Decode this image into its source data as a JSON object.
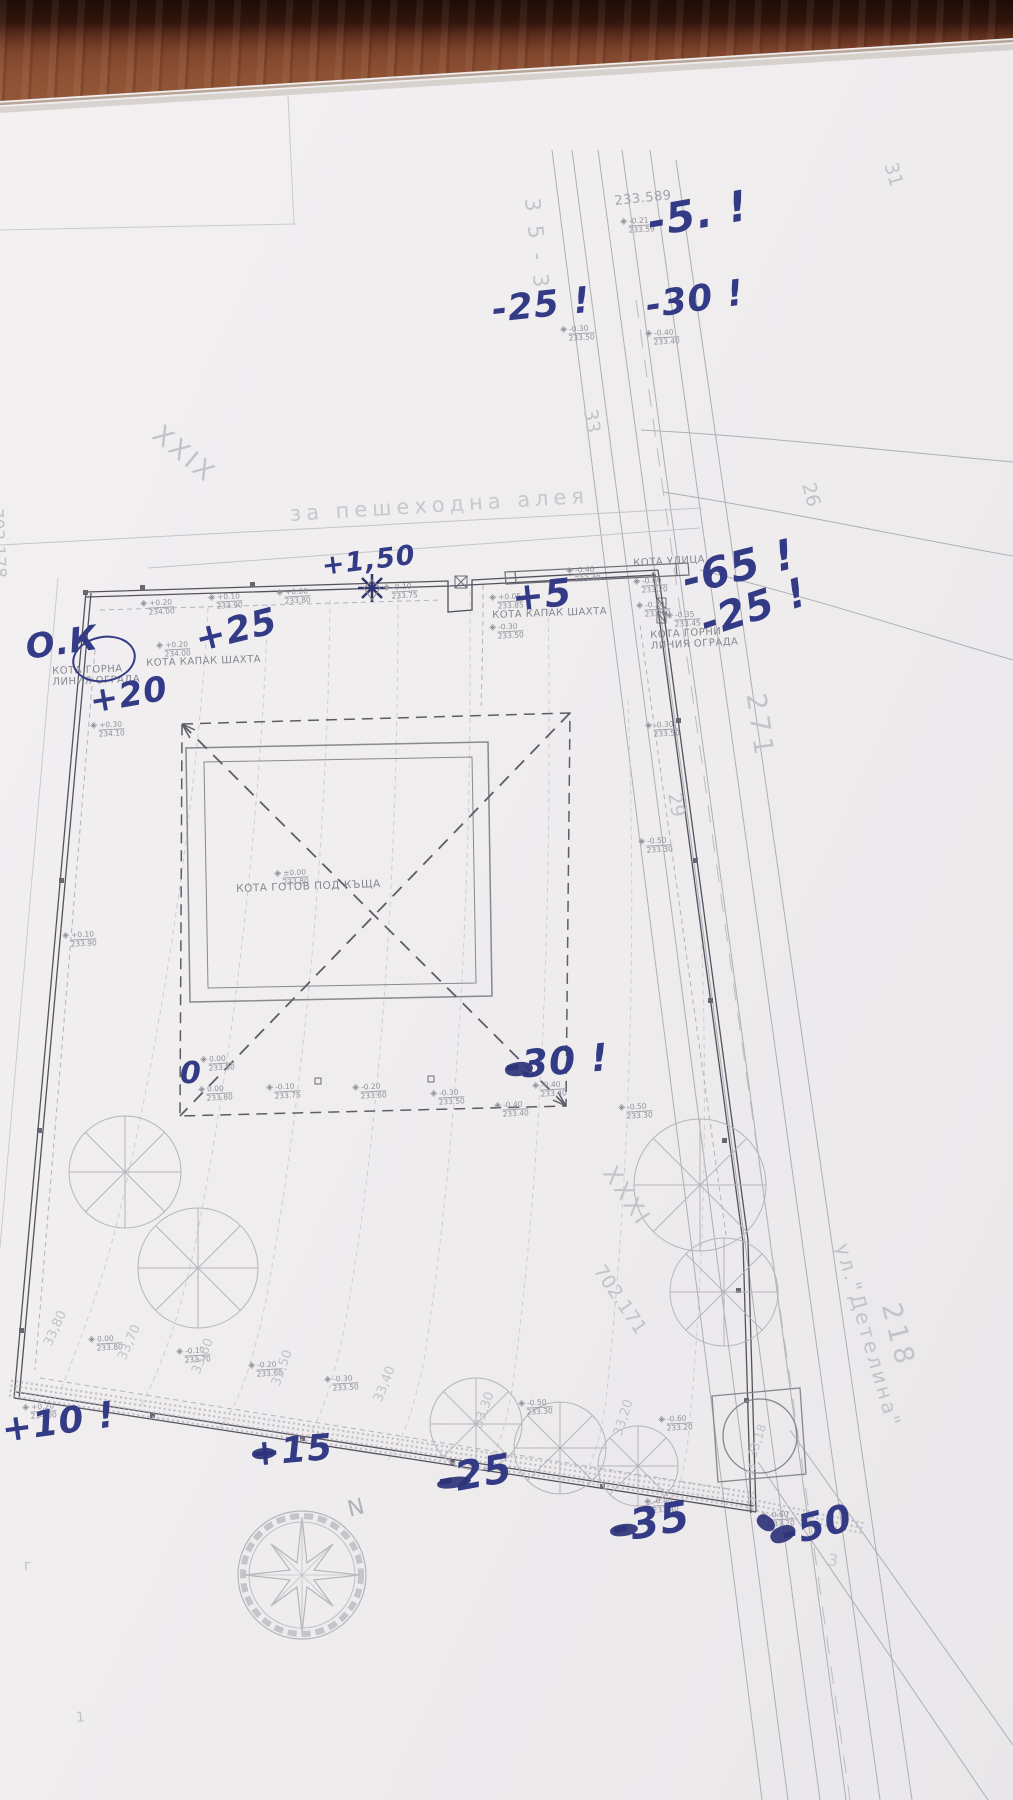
{
  "plan": {
    "handwritten": [
      {
        "text": "-5. !",
        "x": 648,
        "y": 198,
        "size": 42,
        "rot": -10
      },
      {
        "text": "-25 !",
        "x": 492,
        "y": 290,
        "size": 36,
        "rot": -6
      },
      {
        "text": "-30 !",
        "x": 646,
        "y": 286,
        "size": 36,
        "rot": -8
      },
      {
        "text": "+1,50",
        "x": 322,
        "y": 551,
        "size": 27,
        "rot": -7
      },
      {
        "text": "+5",
        "x": 512,
        "y": 576,
        "size": 38,
        "rot": -6
      },
      {
        "text": "-65 !",
        "x": 683,
        "y": 556,
        "size": 42,
        "rot": -14
      },
      {
        "text": "-25 !",
        "x": 702,
        "y": 602,
        "size": 40,
        "rot": -18
      },
      {
        "text": "О.К",
        "x": 26,
        "y": 628,
        "size": 34,
        "rot": -8
      },
      {
        "text": "+25",
        "x": 196,
        "y": 620,
        "size": 36,
        "rot": -14
      },
      {
        "text": "+20",
        "x": 90,
        "y": 682,
        "size": 34,
        "rot": -10
      },
      {
        "text": "0",
        "x": 180,
        "y": 1056,
        "size": 30,
        "rot": 0
      },
      {
        "text": "-30 !",
        "x": 505,
        "y": 1044,
        "size": 38,
        "rot": -5
      },
      {
        "text": "+10 !",
        "x": 2,
        "y": 1410,
        "size": 36,
        "rot": -8
      },
      {
        "text": "+15",
        "x": 250,
        "y": 1434,
        "size": 36,
        "rot": -5
      },
      {
        "text": "-25",
        "x": 438,
        "y": 1458,
        "size": 40,
        "rot": -10
      },
      {
        "text": "-35",
        "x": 612,
        "y": 1504,
        "size": 42,
        "rot": -10
      },
      {
        "text": "-50",
        "x": 782,
        "y": 1512,
        "size": 38,
        "rot": -14
      }
    ],
    "ink_blobs": [
      {
        "x": 505,
        "y": 1062,
        "w": 28,
        "h": 14,
        "rot": -8
      },
      {
        "x": 252,
        "y": 1448,
        "w": 24,
        "h": 11,
        "rot": -6
      },
      {
        "x": 437,
        "y": 1477,
        "w": 34,
        "h": 11,
        "rot": -9
      },
      {
        "x": 610,
        "y": 1524,
        "w": 28,
        "h": 12,
        "rot": -9
      },
      {
        "x": 770,
        "y": 1526,
        "w": 26,
        "h": 16,
        "rot": -25
      },
      {
        "x": 756,
        "y": 1516,
        "w": 20,
        "h": 14,
        "rot": 35
      }
    ],
    "printed_labels": [
      {
        "text": "233.589",
        "x": 614,
        "y": 196,
        "size": 13,
        "rot": -6,
        "color": "#a3a1aa"
      },
      {
        "text": "КОТА УЛИЦА",
        "x": 633,
        "y": 558,
        "size": 10,
        "rot": -3
      },
      {
        "text": "КОТА КАПАК ШАХТА",
        "x": 492,
        "y": 610,
        "size": 10,
        "rot": -2
      },
      {
        "text": "КОТА КАПАК ШАХТА",
        "x": 146,
        "y": 658,
        "size": 10,
        "rot": -2
      },
      {
        "text": "КОТА ГОРНА\nЛИНИЯ ОГРАДА",
        "x": 52,
        "y": 666,
        "size": 10,
        "rot": -2
      },
      {
        "text": "КОТА ГОРНИ\nЛИНИЯ ОГРАДА",
        "x": 650,
        "y": 630,
        "size": 10,
        "rot": -3
      },
      {
        "text": "КОТА ГОТОВ ПОД КЪЩА",
        "x": 236,
        "y": 884,
        "size": 10.5,
        "rot": -2
      }
    ],
    "markers": [
      {
        "top": "-0.21",
        "bot": "233.59",
        "x": 620,
        "y": 218
      },
      {
        "top": "-0.30",
        "bot": "233.50",
        "x": 560,
        "y": 326
      },
      {
        "top": "-0.40",
        "bot": "233.40",
        "x": 645,
        "y": 330
      },
      {
        "top": "+0.20",
        "bot": "234.00",
        "x": 140,
        "y": 600
      },
      {
        "top": "+0.10",
        "bot": "233.90",
        "x": 208,
        "y": 594
      },
      {
        "top": "+0.00",
        "bot": "233.80",
        "x": 276,
        "y": 589
      },
      {
        "top": "-0.10",
        "bot": "233.75",
        "x": 383,
        "y": 584
      },
      {
        "top": "+0.05",
        "bot": "233.85",
        "x": 489,
        "y": 594
      },
      {
        "top": "-0.30",
        "bot": "233.50",
        "x": 489,
        "y": 624
      },
      {
        "top": "-0.40",
        "bot": "233.40",
        "x": 566,
        "y": 567
      },
      {
        "top": "-0.60",
        "bot": "233.20",
        "x": 633,
        "y": 578
      },
      {
        "top": "-0.20",
        "bot": "233.60",
        "x": 636,
        "y": 602
      },
      {
        "top": "-0.35",
        "bot": "233.45",
        "x": 666,
        "y": 612
      },
      {
        "top": "+0.20",
        "bot": "234.00",
        "x": 156,
        "y": 642
      },
      {
        "top": "+0.30",
        "bot": "234.10",
        "x": 90,
        "y": 722
      },
      {
        "top": "+0.10",
        "bot": "233.90",
        "x": 62,
        "y": 932
      },
      {
        "top": "±0.00",
        "bot": "233.80",
        "x": 274,
        "y": 870
      },
      {
        "top": "-0.30",
        "bot": "233.50",
        "x": 645,
        "y": 722
      },
      {
        "top": "-0.50",
        "bot": "233.30",
        "x": 638,
        "y": 838
      },
      {
        "top": "0.00",
        "bot": "233.80",
        "x": 200,
        "y": 1056
      },
      {
        "top": "0.00",
        "bot": "233.80",
        "x": 198,
        "y": 1086
      },
      {
        "top": "-0.10",
        "bot": "233.75",
        "x": 266,
        "y": 1084
      },
      {
        "top": "-0.20",
        "bot": "233.60",
        "x": 352,
        "y": 1084
      },
      {
        "top": "-0.30",
        "bot": "233.50",
        "x": 430,
        "y": 1090
      },
      {
        "top": "-0.40",
        "bot": "233.40",
        "x": 532,
        "y": 1082
      },
      {
        "top": "-0.40",
        "bot": "233.40",
        "x": 494,
        "y": 1102
      },
      {
        "top": "-0.50",
        "bot": "233.30",
        "x": 618,
        "y": 1104
      },
      {
        "top": "+0.20",
        "bot": "234.00",
        "x": 22,
        "y": 1404
      },
      {
        "top": "0.00",
        "bot": "233.80",
        "x": 88,
        "y": 1336
      },
      {
        "top": "-0.10",
        "bot": "233.70",
        "x": 176,
        "y": 1348
      },
      {
        "top": "-0.20",
        "bot": "233.60",
        "x": 248,
        "y": 1362
      },
      {
        "top": "-0.30",
        "bot": "233.50",
        "x": 324,
        "y": 1376
      },
      {
        "top": "-0.50",
        "bot": "233.30",
        "x": 518,
        "y": 1400
      },
      {
        "top": "-0.60",
        "bot": "233.20",
        "x": 658,
        "y": 1416
      },
      {
        "top": "-0.40",
        "bot": "233.40",
        "x": 644,
        "y": 1498
      },
      {
        "top": "-0.60",
        "bot": "233.20",
        "x": 760,
        "y": 1512
      }
    ],
    "faint_labels": [
      {
        "text": "XXIX",
        "x": 156,
        "y": 416,
        "size": 26,
        "rot": 40,
        "ls": 3
      },
      {
        "text": "35-3",
        "x": 532,
        "y": 186,
        "size": 21,
        "rot": 84,
        "ls": 14
      },
      {
        "text": "33",
        "x": 590,
        "y": 398,
        "size": 19,
        "rot": 82
      },
      {
        "text": "31",
        "x": 890,
        "y": 152,
        "size": 19,
        "rot": 74
      },
      {
        "text": "26",
        "x": 808,
        "y": 472,
        "size": 19,
        "rot": 76
      },
      {
        "text": "29",
        "x": 674,
        "y": 782,
        "size": 19,
        "rot": 80
      },
      {
        "text": "271",
        "x": 755,
        "y": 678,
        "size": 27,
        "rot": 82,
        "ls": 5
      },
      {
        "text": "218",
        "x": 890,
        "y": 1288,
        "size": 27,
        "rot": 76,
        "ls": 5
      },
      {
        "text": "XXXI",
        "x": 608,
        "y": 1156,
        "size": 23,
        "rot": 56,
        "ls": 3
      },
      {
        "text": "702.171",
        "x": 598,
        "y": 1256,
        "size": 19,
        "rot": 56
      },
      {
        "text": "702.178",
        "x": -4,
        "y": 498,
        "size": 17,
        "rot": 87
      },
      {
        "text": "ул.\"Детелина\"",
        "x": 842,
        "y": 1232,
        "size": 20,
        "rot": 74,
        "ls": 3
      },
      {
        "text": "за пешеходна алея",
        "x": 290,
        "y": 502,
        "size": 21,
        "rot": -3.5,
        "ls": 5,
        "color": "#c9c7cf"
      },
      {
        "text": "N",
        "x": 348,
        "y": 1498,
        "size": 22,
        "rot": -14,
        "color": "#b2b0b8"
      },
      {
        "text": "33,80",
        "x": 48,
        "y": 1338,
        "size": 13,
        "rot": -66
      },
      {
        "text": "33,70",
        "x": 122,
        "y": 1352,
        "size": 13,
        "rot": -66
      },
      {
        "text": "33,60",
        "x": 196,
        "y": 1366,
        "size": 13,
        "rot": -68
      },
      {
        "text": "33,50",
        "x": 276,
        "y": 1378,
        "size": 13,
        "rot": -70
      },
      {
        "text": "33,40",
        "x": 378,
        "y": 1394,
        "size": 13,
        "rot": -68
      },
      {
        "text": "33,30",
        "x": 478,
        "y": 1420,
        "size": 13,
        "rot": -70
      },
      {
        "text": "33,20",
        "x": 618,
        "y": 1428,
        "size": 13,
        "rot": -72
      },
      {
        "text": "33,18",
        "x": 752,
        "y": 1450,
        "size": 12,
        "rot": -72
      },
      {
        "text": "3",
        "x": 828,
        "y": 1550,
        "size": 16,
        "rot": 8,
        "color": "#cac8d0"
      },
      {
        "text": "15",
        "x": 750,
        "y": 1470,
        "size": 10,
        "rot": -70
      },
      {
        "text": "г",
        "x": 24,
        "y": 1558,
        "size": 14,
        "rot": 0
      },
      {
        "text": "1",
        "x": 76,
        "y": 1710,
        "size": 14,
        "rot": -4
      }
    ]
  }
}
